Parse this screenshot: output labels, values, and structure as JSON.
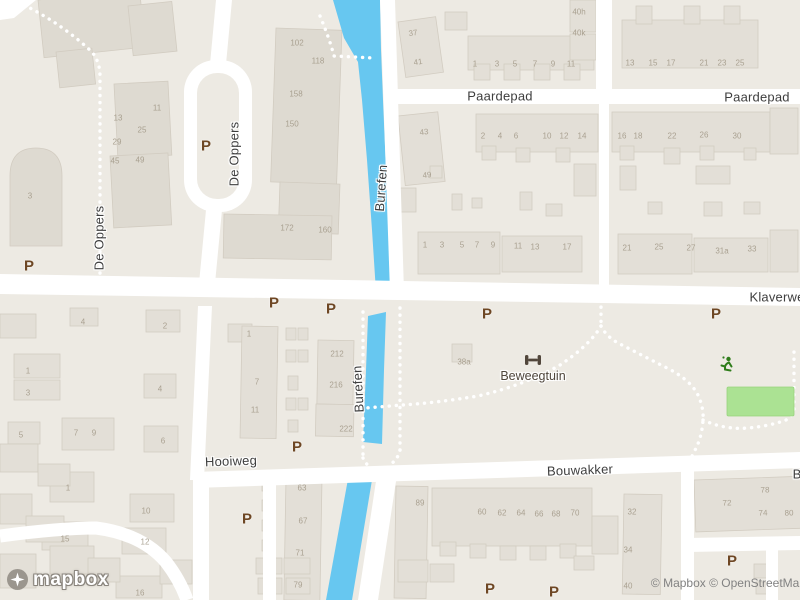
{
  "map": {
    "logo": "mapbox",
    "attribution": "© Mapbox © OpenStreetMap",
    "colors": {
      "land": "#EDEAE3",
      "road": "#FFFFFF",
      "water": "#67C7F0",
      "building": "#E3DFD7",
      "building_outline": "#D2CCC1",
      "field_green": "#ABE293",
      "icon_green": "#2F7D1B",
      "poi_brown": "#6E4724",
      "street_label": "#3E3E3E",
      "house_number": "#A39A89"
    },
    "streets": [
      {
        "n": "Paardepad",
        "x": 500,
        "y": 96,
        "r": 0
      },
      {
        "n": "Paardepad",
        "x": 757,
        "y": 97,
        "r": 0
      },
      {
        "n": "Klaverwe",
        "x": 777,
        "y": 297,
        "r": 0
      },
      {
        "n": "De Oppers",
        "x": 234,
        "y": 154,
        "r": -90
      },
      {
        "n": "De Oppers",
        "x": 99,
        "y": 238,
        "r": -90
      },
      {
        "n": "Burefen",
        "x": 381,
        "y": 188,
        "r": -86
      },
      {
        "n": "Burefen",
        "x": 358,
        "y": 389,
        "r": -93
      },
      {
        "n": "Hooiweg",
        "x": 231,
        "y": 461,
        "r": -2
      },
      {
        "n": "Bouwakker",
        "x": 580,
        "y": 470,
        "r": -2
      },
      {
        "n": "B",
        "x": 797,
        "y": 474,
        "r": 0
      }
    ],
    "pois": [
      {
        "n": "Beweegtuin",
        "x": 533,
        "y": 376,
        "r": 0
      }
    ],
    "icons": [
      {
        "name": "dumbbell-icon",
        "x": 533,
        "y": 357
      },
      {
        "name": "sports-person-icon",
        "x": 726,
        "y": 365
      },
      {
        "name": "mapbox-logo-icon",
        "x": 18,
        "y": 580
      }
    ],
    "parking_symbol": "P",
    "parking": [
      [
        29,
        266
      ],
      [
        206,
        146
      ],
      [
        274,
        303
      ],
      [
        331,
        309
      ],
      [
        487,
        314
      ],
      [
        716,
        314
      ],
      [
        297,
        447
      ],
      [
        247,
        519
      ],
      [
        490,
        589
      ],
      [
        554,
        592
      ],
      [
        732,
        561
      ]
    ],
    "house_numbers": [
      [
        "102",
        297,
        43
      ],
      [
        "118",
        318,
        61
      ],
      [
        "158",
        296,
        94
      ],
      [
        "150",
        292,
        124
      ],
      [
        "172",
        287,
        228
      ],
      [
        "160",
        325,
        230
      ],
      [
        "11",
        157,
        108
      ],
      [
        "13",
        118,
        118
      ],
      [
        "25",
        142,
        130
      ],
      [
        "29",
        117,
        142
      ],
      [
        "45",
        115,
        161
      ],
      [
        "49",
        140,
        160
      ],
      [
        "3",
        30,
        196
      ],
      [
        "37",
        413,
        33,
        -8
      ],
      [
        "41",
        418,
        62,
        -8
      ],
      [
        "1",
        475,
        64
      ],
      [
        "3",
        497,
        64
      ],
      [
        "5",
        515,
        64
      ],
      [
        "7",
        535,
        64
      ],
      [
        "9",
        553,
        64
      ],
      [
        "11",
        571,
        64
      ],
      [
        "40h",
        579,
        12
      ],
      [
        "40k",
        579,
        33
      ],
      [
        "13",
        630,
        63
      ],
      [
        "15",
        653,
        63
      ],
      [
        "17",
        671,
        63
      ],
      [
        "21",
        704,
        63
      ],
      [
        "23",
        722,
        63
      ],
      [
        "25",
        740,
        63
      ],
      [
        "43",
        424,
        132,
        -6
      ],
      [
        "49",
        427,
        175,
        -6
      ],
      [
        "2",
        483,
        136
      ],
      [
        "4",
        500,
        136
      ],
      [
        "6",
        516,
        136
      ],
      [
        "10",
        547,
        136
      ],
      [
        "12",
        564,
        136
      ],
      [
        "14",
        582,
        136
      ],
      [
        "16",
        622,
        136
      ],
      [
        "18",
        638,
        136
      ],
      [
        "22",
        672,
        136
      ],
      [
        "26",
        704,
        135
      ],
      [
        "30",
        737,
        136
      ],
      [
        "1",
        425,
        245
      ],
      [
        "3",
        442,
        245
      ],
      [
        "5",
        462,
        245
      ],
      [
        "7",
        477,
        245
      ],
      [
        "9",
        493,
        245
      ],
      [
        "11",
        518,
        246
      ],
      [
        "13",
        535,
        247
      ],
      [
        "17",
        567,
        247
      ],
      [
        "21",
        627,
        248
      ],
      [
        "25",
        659,
        247
      ],
      [
        "27",
        691,
        248
      ],
      [
        "31a",
        722,
        251
      ],
      [
        "33",
        752,
        249
      ],
      [
        "2",
        165,
        326
      ],
      [
        "4",
        83,
        322
      ],
      [
        "1",
        28,
        371
      ],
      [
        "3",
        28,
        393
      ],
      [
        "5",
        21,
        435
      ],
      [
        "7",
        76,
        433
      ],
      [
        "9",
        94,
        433
      ],
      [
        "4",
        160,
        389
      ],
      [
        "6",
        163,
        441
      ],
      [
        "1",
        68,
        488
      ],
      [
        "10",
        146,
        511
      ],
      [
        "15",
        65,
        539
      ],
      [
        "12",
        145,
        542
      ],
      [
        "16",
        140,
        593
      ],
      [
        "1",
        249,
        334
      ],
      [
        "7",
        257,
        382
      ],
      [
        "11",
        255,
        410
      ],
      [
        "212",
        337,
        354
      ],
      [
        "216",
        336,
        385
      ],
      [
        "222",
        346,
        429
      ],
      [
        "38a",
        464,
        362
      ],
      [
        "63",
        302,
        488
      ],
      [
        "67",
        303,
        521
      ],
      [
        "71",
        300,
        553
      ],
      [
        "79",
        298,
        585
      ],
      [
        "89",
        420,
        503
      ],
      [
        "60",
        482,
        512
      ],
      [
        "62",
        502,
        513
      ],
      [
        "64",
        521,
        513
      ],
      [
        "66",
        539,
        514
      ],
      [
        "68",
        556,
        514
      ],
      [
        "70",
        575,
        513
      ],
      [
        "32",
        632,
        512
      ],
      [
        "34",
        628,
        550
      ],
      [
        "40",
        628,
        586
      ],
      [
        "72",
        727,
        503,
        -2
      ],
      [
        "78",
        765,
        490,
        -2
      ],
      [
        "74",
        763,
        513,
        -2
      ],
      [
        "80",
        789,
        513,
        -2
      ]
    ]
  }
}
